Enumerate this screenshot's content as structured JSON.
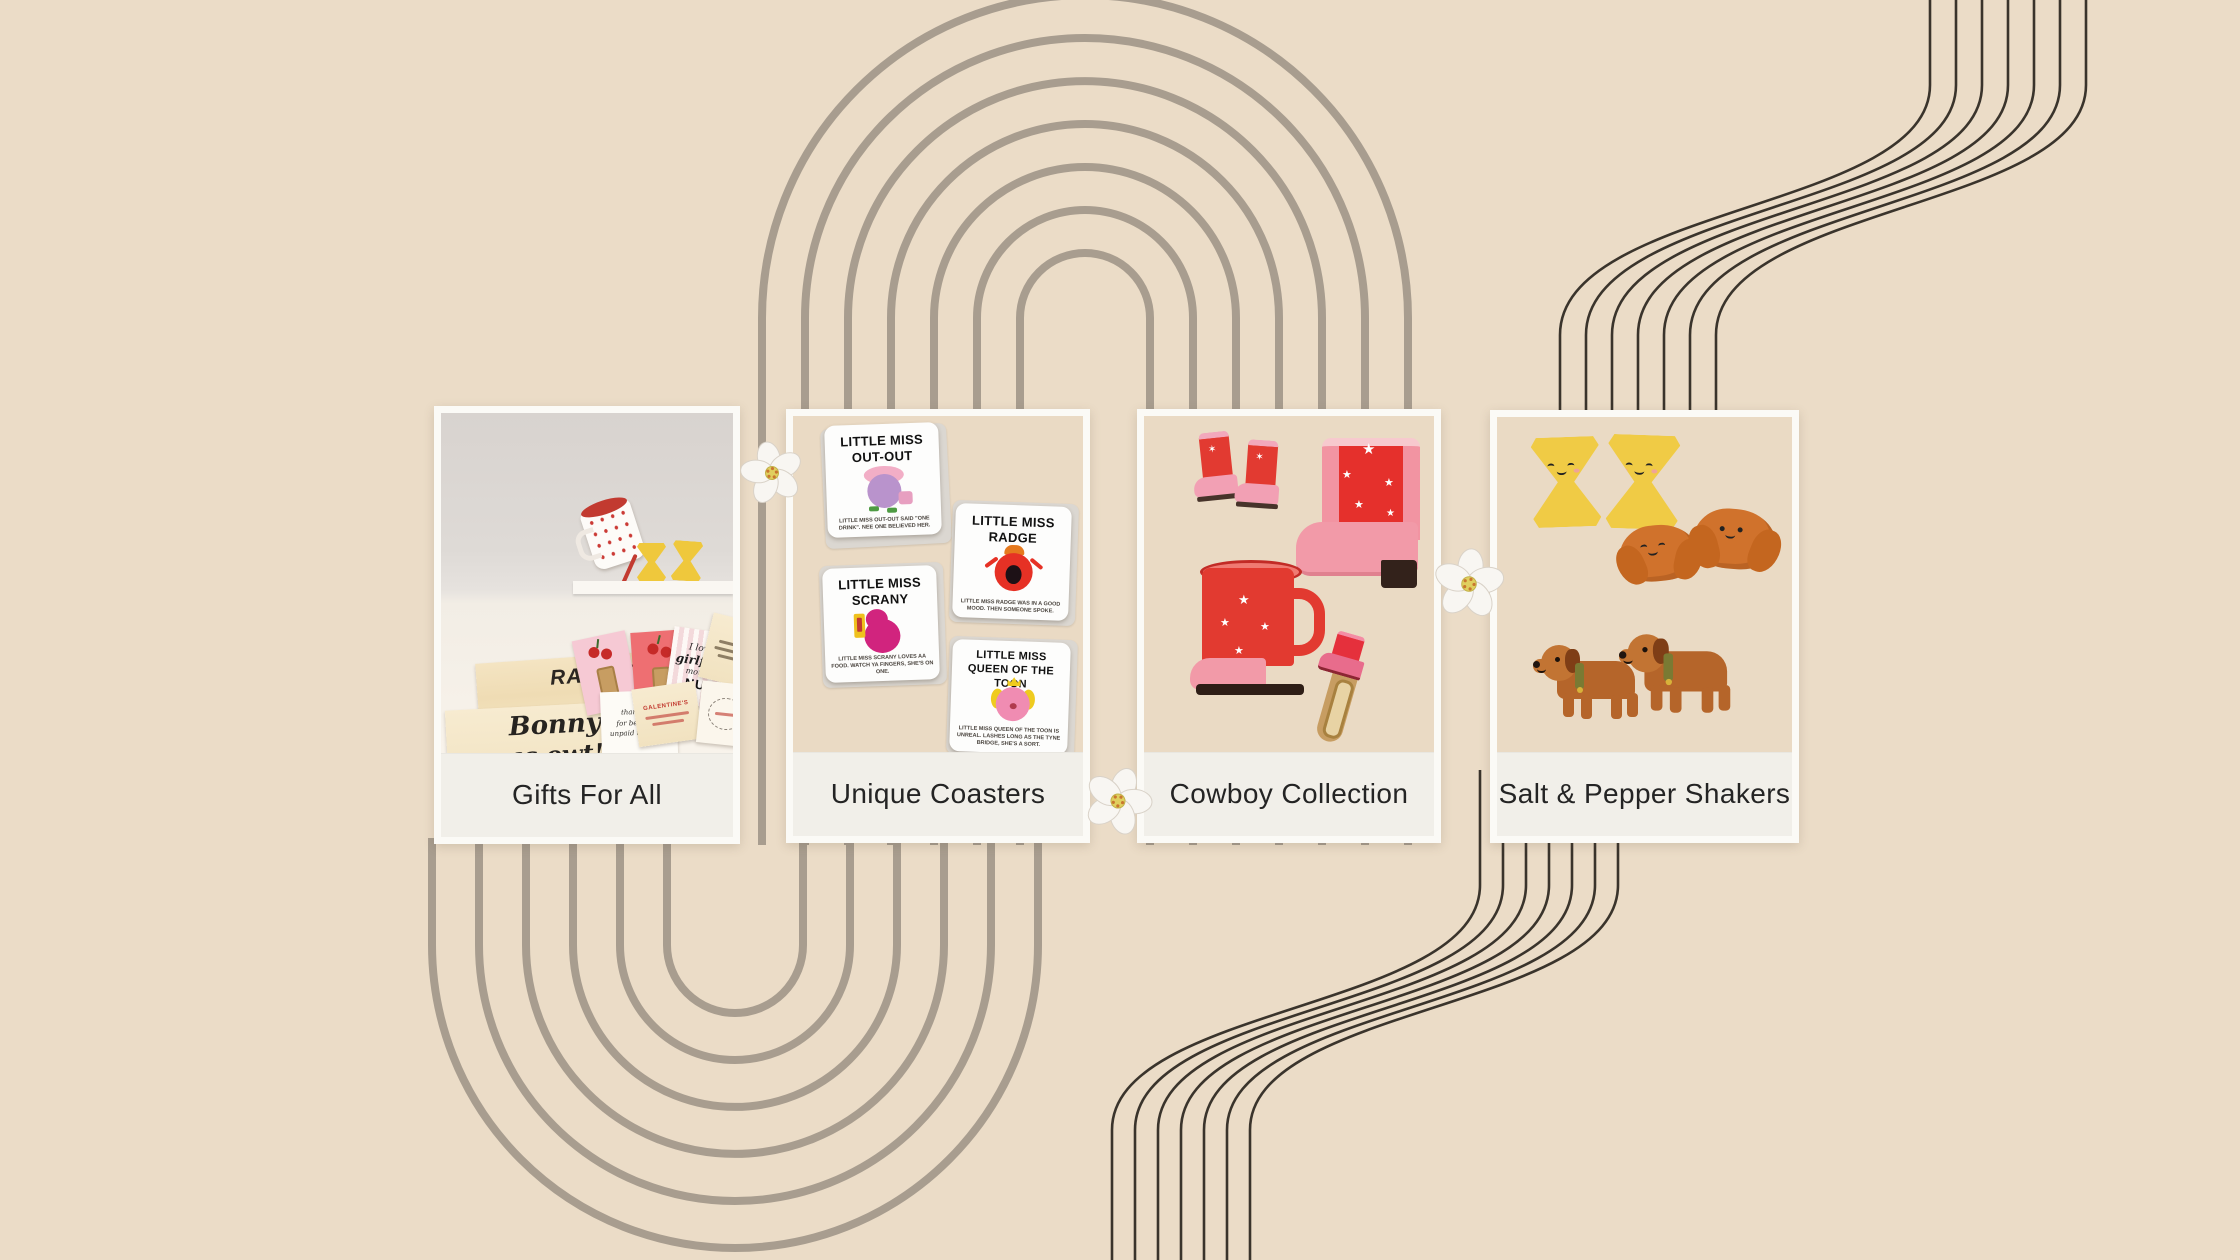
{
  "page": {
    "background": "#EBDCC7"
  },
  "decor": {
    "arch_color": "#A89D8F",
    "ribbon_color": "#3A342C",
    "flower_petal_color": "#F8F6F2",
    "flower_center_color": "#E0CF5F"
  },
  "cards": [
    {
      "label": "Gifts For All"
    },
    {
      "label": "Unique Coasters",
      "coasters": [
        {
          "line1": "LITTLE MISS",
          "line2": "OUT-OUT",
          "caption": "LITTLE MISS OUT-OUT SAID \"ONE DRINK\". NEE ONE BELIEVED HER."
        },
        {
          "line1": "LITTLE MISS",
          "line2": "RADGE",
          "caption": "LITTLE MISS RADGE WAS IN A GOOD MOOD. THEN SOMEONE SPOKE."
        },
        {
          "line1": "LITTLE MISS",
          "line2": "SCRANY",
          "caption": "LITTLE MISS SCRANY LOVES AA FOOD. WATCH YA FINGERS, SHE'S ON ONE."
        },
        {
          "line1": "LITTLE MISS",
          "line2": "QUEEN OF THE TOON",
          "caption": "LITTLE MISS QUEEN OF THE TOON IS UNREAL. LASHES LONG AS THE TYNE BRIDGE, SHE'S A SORT."
        }
      ]
    },
    {
      "label": "Cowboy Collection"
    },
    {
      "label": "Salt & Pepper Shakers"
    }
  ],
  "photo": {
    "radgie": "RADGIE...",
    "bonny_line1": "Bonny",
    "bonny_line2": "as owt!",
    "thankyou_line1": "thank you",
    "thankyou_line2": "for being my",
    "thankyou_line3": "unpaid therapist",
    "galentine": "GALENTINE'S",
    "nufc_line1": "I love my",
    "nufc_line2": "girlfriend",
    "nufc_line3": "more than",
    "nufc_line4": "NUFC"
  }
}
